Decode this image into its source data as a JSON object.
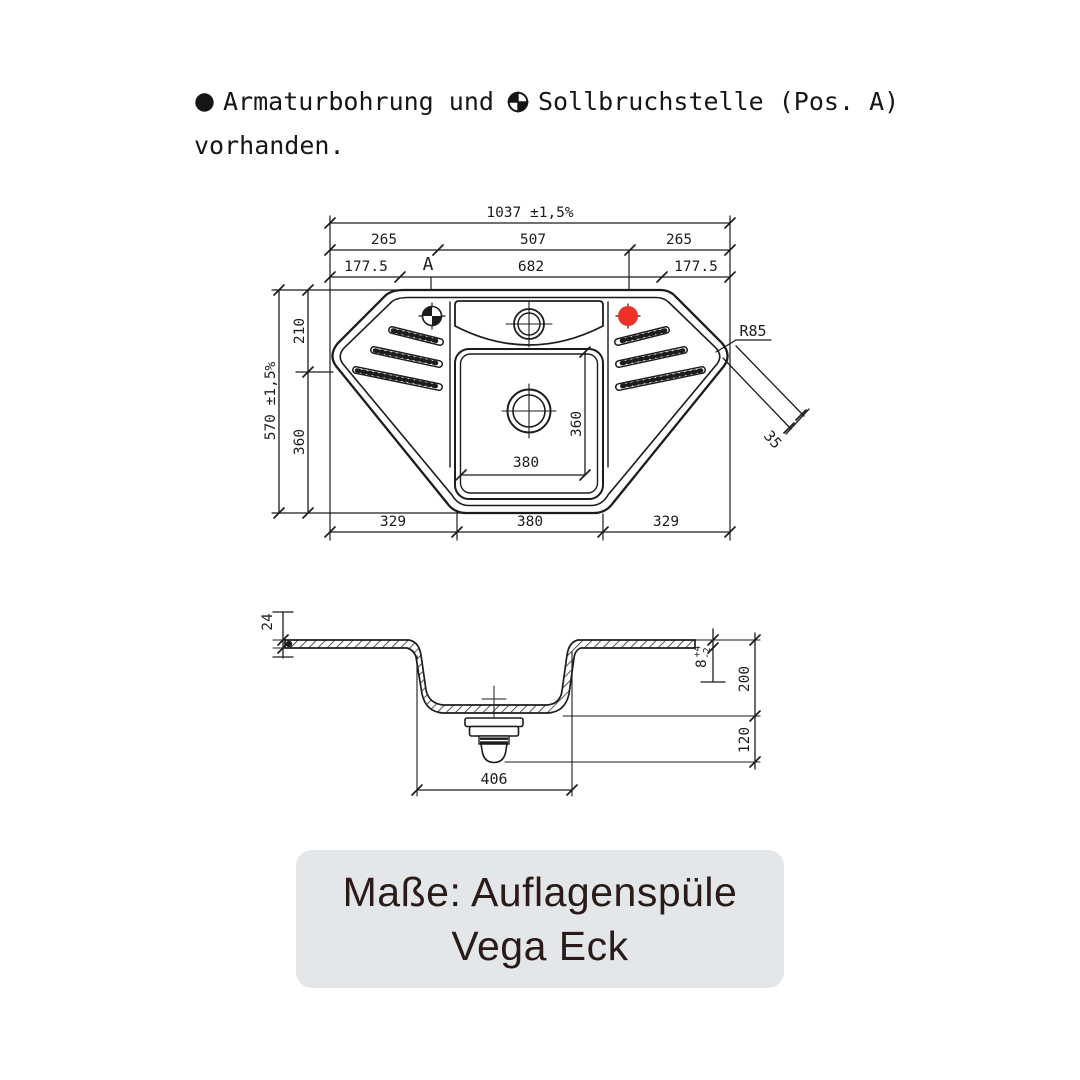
{
  "legend": {
    "text_before_symbol": "Armaturbohrung und",
    "text_after_symbol": "Sollbruchstelle (Pos. A)",
    "line2": "vorhanden."
  },
  "top_view": {
    "overall_width": "1037 ±1,5%",
    "width_left": "265",
    "width_center": "507",
    "width_right": "265",
    "width2_left": "177.5",
    "width2_center": "682",
    "width2_right": "177.5",
    "position_label": "A",
    "overall_height": "570 ±1,5%",
    "height_top": "210",
    "height_bottom": "360",
    "basin_width": "380",
    "basin_height": "360",
    "bottom_left": "329",
    "bottom_center": "380",
    "bottom_right": "329",
    "corner_radius": "R85",
    "rim_width": "35"
  },
  "section_view": {
    "rim_height": "24",
    "flange_thickness": "8",
    "tol_plus": "+4",
    "tol_minus": "-2",
    "basin_depth": "200",
    "drain_clearance": "120",
    "basin_width": "406"
  },
  "caption": {
    "line1": "Maße: Auflagenspüle",
    "line2": "Vega Eck"
  },
  "colors": {
    "line": "#1c1c1c",
    "accent_red": "#ee3124",
    "card_bg": "#e4e7ea",
    "card_text": "#2a1b18"
  }
}
